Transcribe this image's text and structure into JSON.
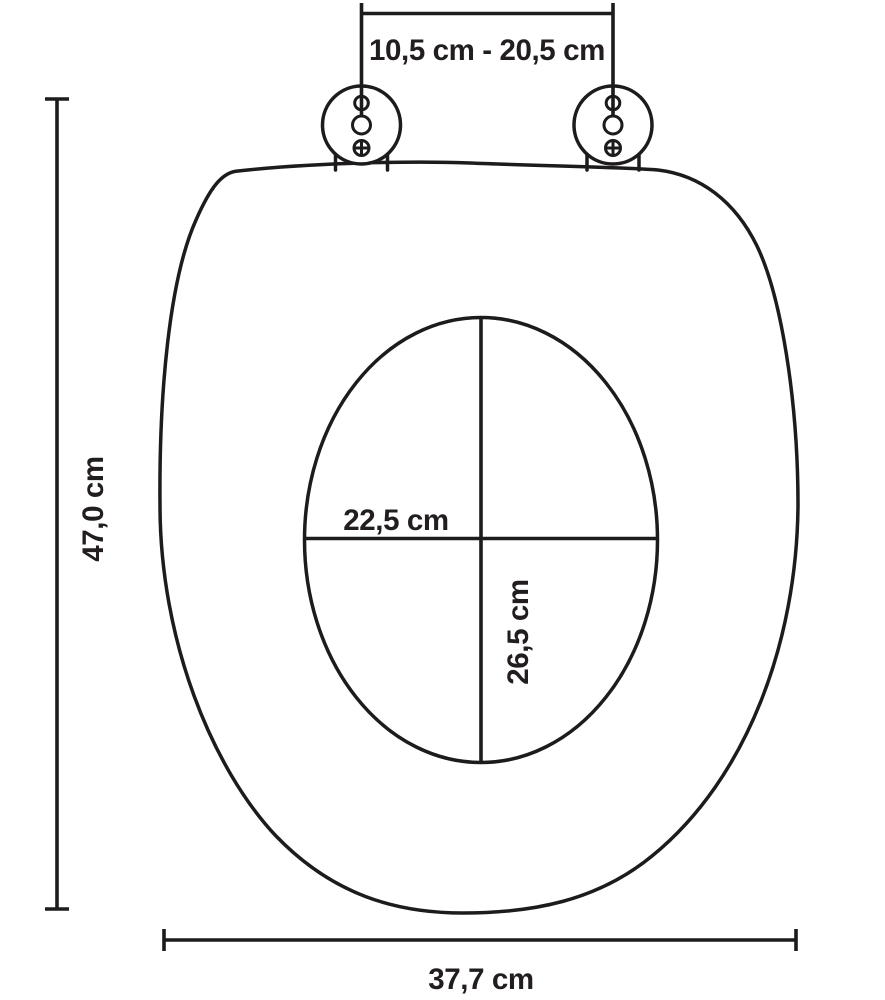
{
  "diagram": {
    "title": "Toilet seat technical dimension drawing (top view)",
    "background_color": "#ffffff",
    "line_color": "#1d1b1b",
    "text_color": "#221e1f",
    "dimensions": {
      "hinge_spacing": {
        "label": "10,5 cm - 20,5 cm",
        "meaning": "adjustable hinge bolt distance"
      },
      "overall_length": {
        "label": "47,0 cm",
        "meaning": "total seat length"
      },
      "inner_cutout_width": {
        "label": "22,5 cm",
        "meaning": "inner opening width"
      },
      "inner_cutout_length": {
        "label": "26,5 cm",
        "meaning": "inner opening length"
      },
      "overall_width": {
        "label": "37,7 cm",
        "meaning": "total seat width"
      }
    }
  }
}
